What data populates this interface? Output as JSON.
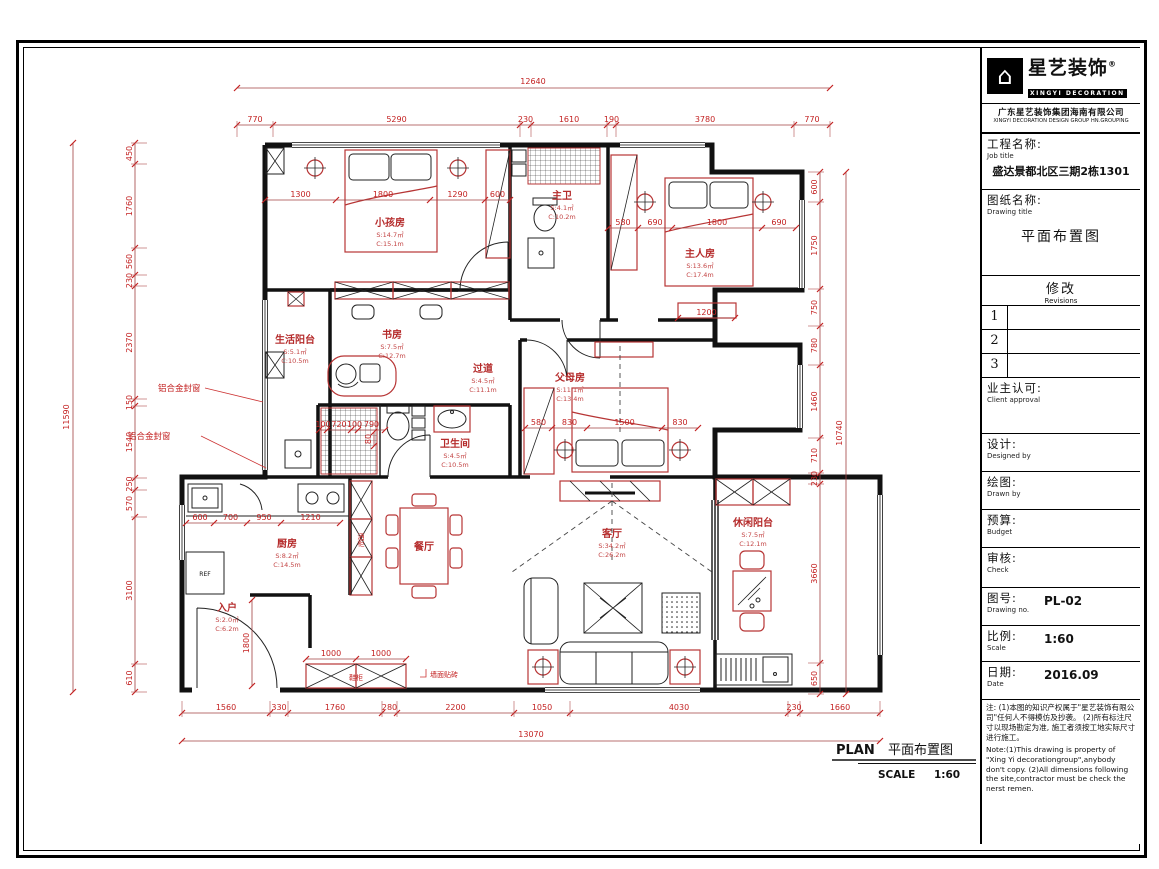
{
  "sheet": {
    "plan_title_en": "PLAN",
    "plan_title_cn": "平面布置图",
    "scale_label": "SCALE",
    "scale_value": "1:60"
  },
  "title_block": {
    "logo": {
      "cn": "星艺装饰",
      "reg": "®",
      "en": "XINGYI DECORATION"
    },
    "company_cn": "广东星艺装饰集团海南有限公司",
    "company_en": "XINGYI DECORATION DESIGN GROUP HN.GROUPING",
    "job": {
      "label_cn": "工程名称:",
      "label_en": "Job title",
      "value": "盛达景都北区三期2栋1301"
    },
    "drawing": {
      "label_cn": "图纸名称:",
      "label_en": "Drawing title",
      "value": "平面布置图"
    },
    "revisions": {
      "title_cn": "修改",
      "title_en": "Revisions",
      "rows": [
        "1",
        "2",
        "3"
      ]
    },
    "client": {
      "label_cn": "业主认可:",
      "label_en": "Client approval"
    },
    "designed": {
      "label_cn": "设计:",
      "label_en": "Designed by"
    },
    "drawn": {
      "label_cn": "绘图:",
      "label_en": "Drawn by"
    },
    "budget": {
      "label_cn": "预算:",
      "label_en": "Budget"
    },
    "check": {
      "label_cn": "审核:",
      "label_en": "Check"
    },
    "drawing_no": {
      "label_cn": "图号:",
      "label_en": "Drawing no.",
      "value": "PL-02"
    },
    "scale": {
      "label_cn": "比例:",
      "label_en": "Scale",
      "value": "1:60"
    },
    "date": {
      "label_cn": "日期:",
      "label_en": "Date",
      "value": "2016.09"
    },
    "notes_cn": "注: (1)本图的知识产权属于\"星艺装饰有限公司\"任何人不得模仿及抄袭。 (2)所有标注尺寸以现场勘定为准, 施工者须按工地实际尺寸进行施工。",
    "notes_en": "Note:(1)This drawing is property of \"Xing Yi decorationgroup\",anybody don't copy.  (2)All dimensions following the site,contractor must be check the nerst remen."
  },
  "dims": {
    "top": {
      "overall": "12640",
      "segments": [
        "770",
        "5290",
        "230",
        "1610",
        "190",
        "3780",
        "770"
      ]
    },
    "bottom": {
      "overall": "13070",
      "segments": [
        "1560",
        "330",
        "1760",
        "280",
        "2200",
        "1050",
        "4030",
        "230",
        "1660"
      ]
    },
    "left": {
      "overall": "11590",
      "segments": [
        "450",
        "1760",
        "560",
        "230",
        "2370",
        "150",
        "1540",
        "250",
        "570",
        "3100",
        "610"
      ]
    },
    "right": {
      "overall": "10740",
      "segments": [
        "600",
        "1750",
        "750",
        "780",
        "1460",
        "710",
        "230",
        "3660",
        "650"
      ]
    },
    "children_row": [
      "1300",
      "1800",
      "1290",
      "600"
    ],
    "master_row": [
      "580",
      "690",
      "1800",
      "690"
    ],
    "master_below": [
      "1200"
    ],
    "parents_row": [
      "580",
      "830",
      "1500",
      "830"
    ],
    "bath_row": [
      "100",
      "720",
      "100",
      "790"
    ],
    "bath_v": [
      "80"
    ],
    "kitchen_row": [
      "600",
      "700",
      "950",
      "1210"
    ],
    "entry_v": [
      "1800"
    ],
    "shoe_row": [
      "1000",
      "1000"
    ]
  },
  "rooms": [
    {
      "name": "小孩房",
      "s": "S:14.7㎡",
      "c": "C:15.1m"
    },
    {
      "name": "主人房",
      "s": "S:13.6㎡",
      "c": "C:17.4m"
    },
    {
      "name": "主卫",
      "s": "S:4.1㎡",
      "c": "C:10.2m"
    },
    {
      "name": "书房",
      "s": "S:7.5㎡",
      "c": "C:12.7m"
    },
    {
      "name": "生活阳台",
      "s": "S:5.1㎡",
      "c": "C:10.5m"
    },
    {
      "name": "过道",
      "s": "S:4.5㎡",
      "c": "C:11.1m"
    },
    {
      "name": "父母房",
      "s": "S:11.1㎡",
      "c": "C:13.4m"
    },
    {
      "name": "卫生间",
      "s": "S:4.5㎡",
      "c": "C:10.5m"
    },
    {
      "name": "厨房",
      "s": "S:8.2㎡",
      "c": "C:14.5m"
    },
    {
      "name": "餐厅",
      "s": "",
      "c": ""
    },
    {
      "name": "客厅",
      "s": "S:34.2㎡",
      "c": "C:26.2m"
    },
    {
      "name": "休闲阳台",
      "s": "S:7.5㎡",
      "c": "C:12.1m"
    },
    {
      "name": "入户",
      "s": "S:2.0㎡",
      "c": "C:6.2m"
    }
  ],
  "annotations": {
    "alu_window_1": "铝合金封窗",
    "alu_window_2": "铝合金封窗",
    "wall_tile": "墙面贴砖",
    "ref": "REF",
    "wine_cabinet": "酒柜",
    "shoe_cabinet": "鞋柜"
  },
  "colors": {
    "dim_red": "#c32222",
    "wall_black": "#111111"
  }
}
